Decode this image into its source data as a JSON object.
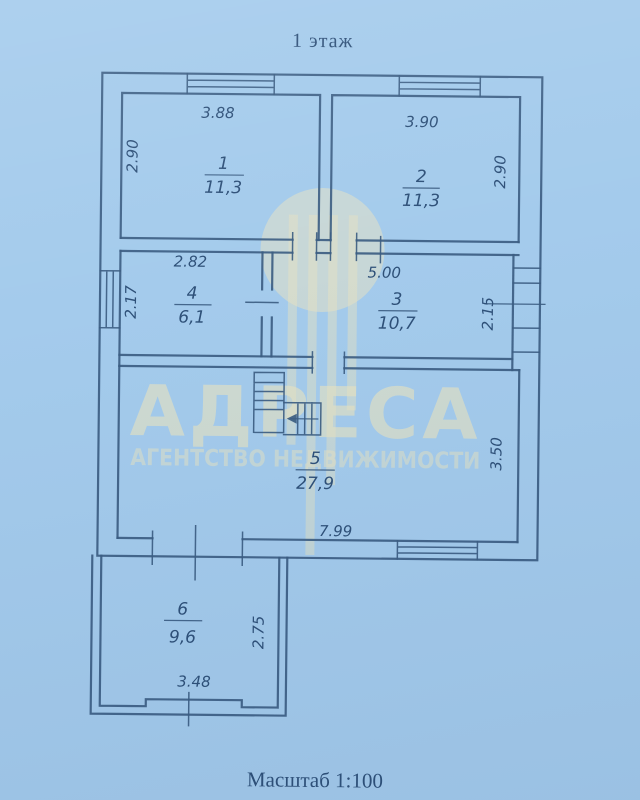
{
  "title": "1 этаж",
  "scale_label": "Масштаб 1:100",
  "watermark": {
    "brand": "АДРЕСА",
    "subtitle": "АГЕНТСТВО НЕДВИЖИМОСТИ"
  },
  "colors": {
    "background": "#a4cbec",
    "line": "#3c5d82",
    "text": "#2e5078",
    "watermark": "#e9e4c2"
  },
  "rooms": [
    {
      "number": "1",
      "area": "11,3"
    },
    {
      "number": "2",
      "area": "11,3"
    },
    {
      "number": "3",
      "area": "10,7"
    },
    {
      "number": "4",
      "area": "6,1"
    },
    {
      "number": "5",
      "area": "27,9"
    },
    {
      "number": "6",
      "area": "9,6"
    }
  ],
  "dimensions": {
    "room1_top": "3.88",
    "room1_left": "2.90",
    "room2_top": "3.90",
    "room2_right": "2.90",
    "room4_top": "2.82",
    "room4_left": "2.17",
    "room3_top": "5.00",
    "room3_right": "2.15",
    "room5_bottom": "7.99",
    "room5_right": "3.50",
    "room6_bottom": "3.48",
    "room6_right": "2.75"
  }
}
